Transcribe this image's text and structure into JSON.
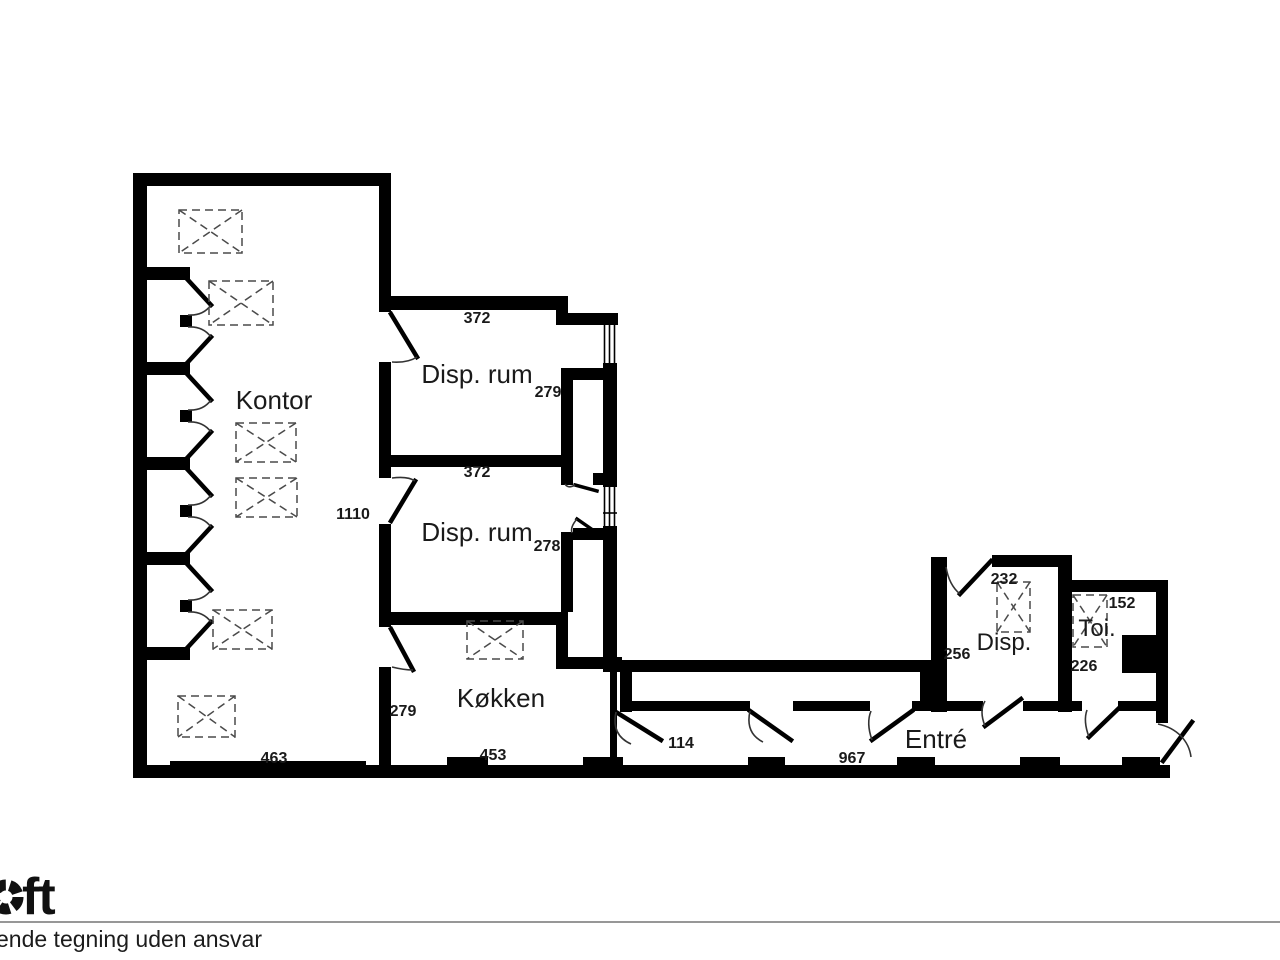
{
  "colors": {
    "wall": "#000000",
    "line": "#333333",
    "dashed_symbol": "#4a4a4a",
    "text": "#1a1a1a",
    "divider": "#757575",
    "background": "#ffffff"
  },
  "icons": {
    "radiator": "dashed-box-with-crossed-diagonals",
    "door": "leaf-line-with-quarter-arc",
    "window": "double-parallel-lines",
    "logo_aperture": "segmented-ring"
  },
  "floorplan": {
    "rooms": {
      "kontor": "Kontor",
      "disp_rum_1": "Disp. rum",
      "disp_rum_2": "Disp. rum",
      "kokken": "Køkken",
      "entre": "Entré",
      "disp": "Disp.",
      "toi": "Toi."
    },
    "dims": {
      "d372_top": "372",
      "d279_disp1": "279",
      "d372_mid": "372",
      "d278": "278",
      "d1110": "1110",
      "d279_kokken": "279",
      "d463": "463",
      "d453": "453",
      "d114": "114",
      "d967": "967",
      "d232": "232",
      "d256": "256",
      "d152": "152",
      "d226": "226"
    }
  },
  "footer": {
    "logo_text": "ft",
    "disclaimer": "ende tegning uden ansvar"
  }
}
